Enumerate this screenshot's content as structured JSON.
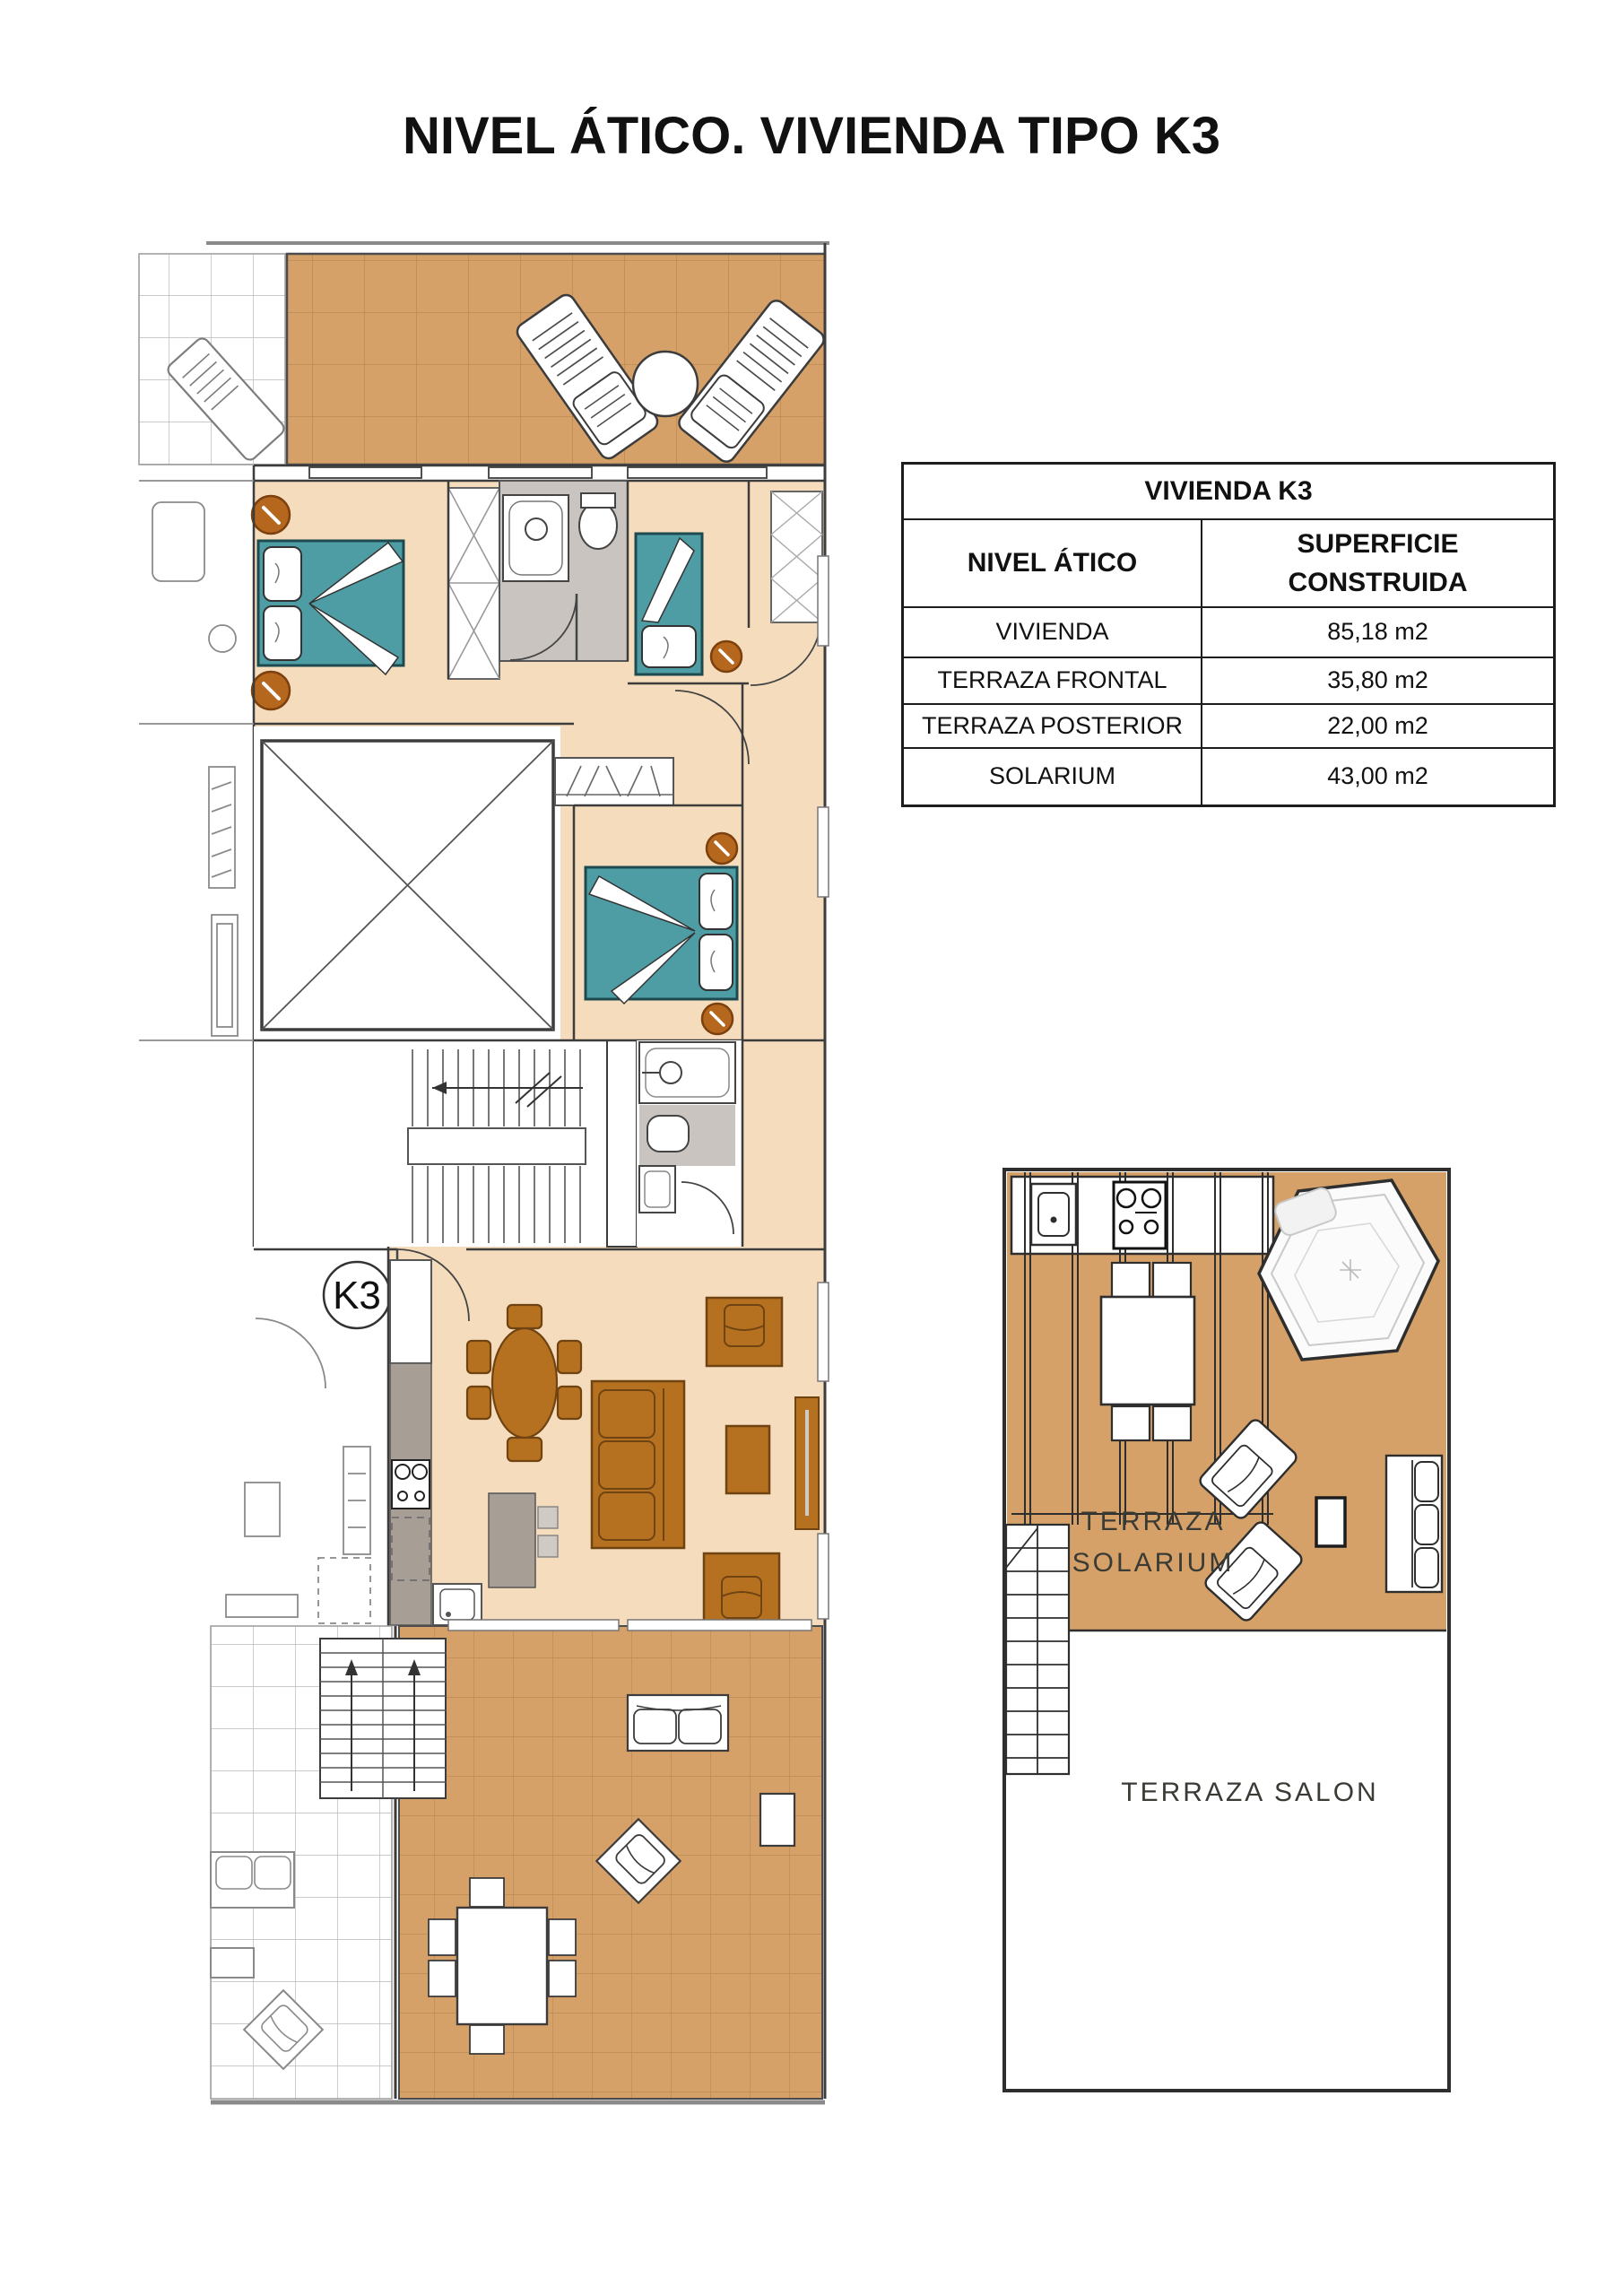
{
  "page": {
    "title": "NIVEL ÁTICO. VIVIENDA TIPO K3"
  },
  "table": {
    "title": "VIVIENDA K3",
    "col1_header": "NIVEL ÁTICO",
    "col2_header": "SUPERFICIE CONSTRUIDA",
    "rows": [
      {
        "label": "VIVIENDA",
        "value": "85,18 m2"
      },
      {
        "label": "TERRAZA FRONTAL",
        "value": "35,80 m2"
      },
      {
        "label": "TERRAZA POSTERIOR",
        "value": "22,00 m2"
      },
      {
        "label": "SOLARIUM",
        "value": "43,00 m2"
      }
    ]
  },
  "plan": {
    "unit_badge": "K3"
  },
  "solarium_plan": {
    "terrace_label_line1": "TERRAZA",
    "terrace_label_line2": "SOLARIUM",
    "salon_label": "TERRAZA SALON"
  },
  "colors": {
    "terrace_tan": "#d5a169",
    "tile_line_tan": "#bb8c55",
    "interior_beige": "#f5dcbd",
    "bed_teal": "#4f9da4",
    "accent_orange": "#b5671d",
    "furniture_brown": "#b5711f",
    "furniture_brown_border": "#6f4312",
    "bathroom_gray": "#c9c4bf",
    "counter_gray": "#a79e95",
    "wall_dark": "#3c3c3c",
    "outline_gray": "#8a8a8a"
  }
}
